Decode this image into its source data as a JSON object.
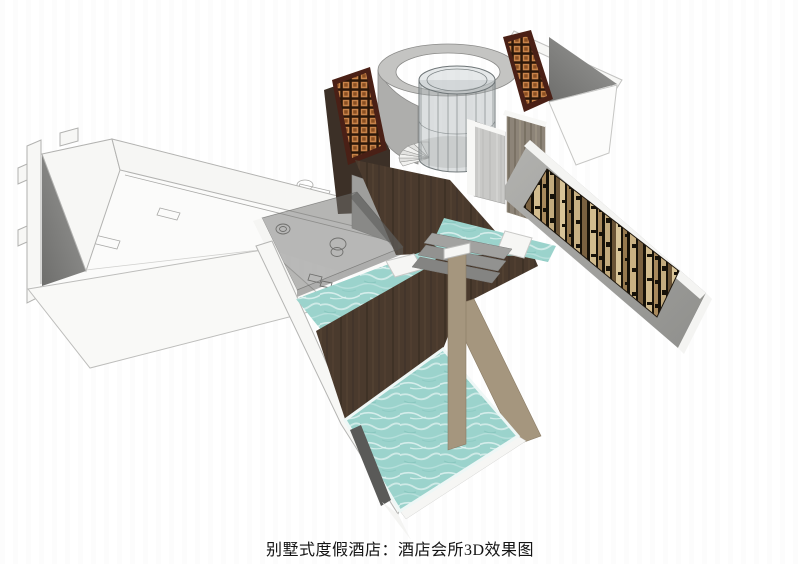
{
  "caption": {
    "text": "别墅式度假酒店：酒店会所3D效果图"
  },
  "scene": {
    "kind": "3d-architectural-rendering",
    "elements": {
      "left_wing": "white-villa-wing",
      "rotunda": "glass-cylinder-rotunda-with-spiral-staircase",
      "entry_screens": "orange-lattice-panels",
      "feature_wall": "striped-decorative-wall",
      "pools": "two-turquoise-pools-with-wood-deck"
    }
  },
  "colors": {
    "water": "#9bd3cc",
    "wood": "#4a3a2d",
    "deckTan": "#a5967e",
    "latticeOrange": "#c8834a",
    "latticeFrame": "#4a2016",
    "panelTan": "#d8c498",
    "panelDark": "#171209",
    "wallWhite": "#f7f7f5",
    "wallShadow": "#6f6f6d",
    "concrete": "#c9c9c7",
    "glass": "#a8afb1",
    "captionColor": "#141414"
  }
}
